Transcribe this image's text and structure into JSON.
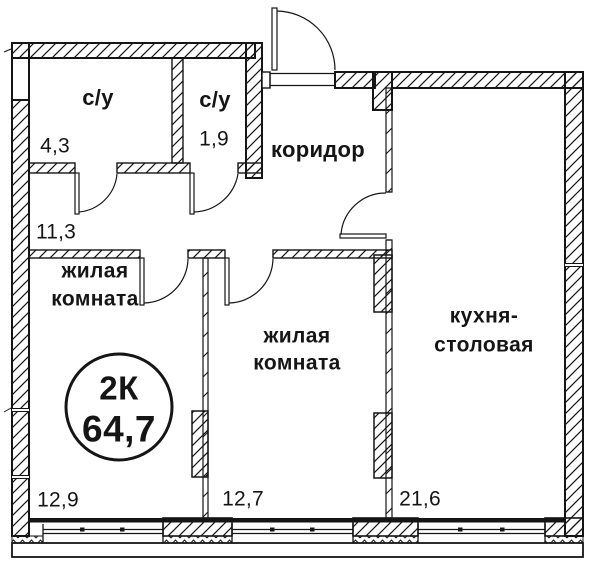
{
  "plan": {
    "badge": {
      "type": "2К",
      "total_area": "64,7"
    },
    "rooms": [
      {
        "id": "bathroom-1",
        "name": "с/у",
        "area": "4,3"
      },
      {
        "id": "bathroom-2",
        "name": "с/у",
        "area": "1,9"
      },
      {
        "id": "corridor",
        "name": "коридор",
        "area": "11,3"
      },
      {
        "id": "living-room-1",
        "name_line1": "жилая",
        "name_line2": "комната",
        "area": "12,9"
      },
      {
        "id": "living-room-2",
        "name_line1": "жилая",
        "name_line2": "комната",
        "area": "12,7"
      },
      {
        "id": "kitchen-dining",
        "name_line1": "кухня-",
        "name_line2": "столовая",
        "area": "21,6"
      }
    ],
    "colors": {
      "line": "#151515",
      "background": "#ffffff"
    }
  }
}
